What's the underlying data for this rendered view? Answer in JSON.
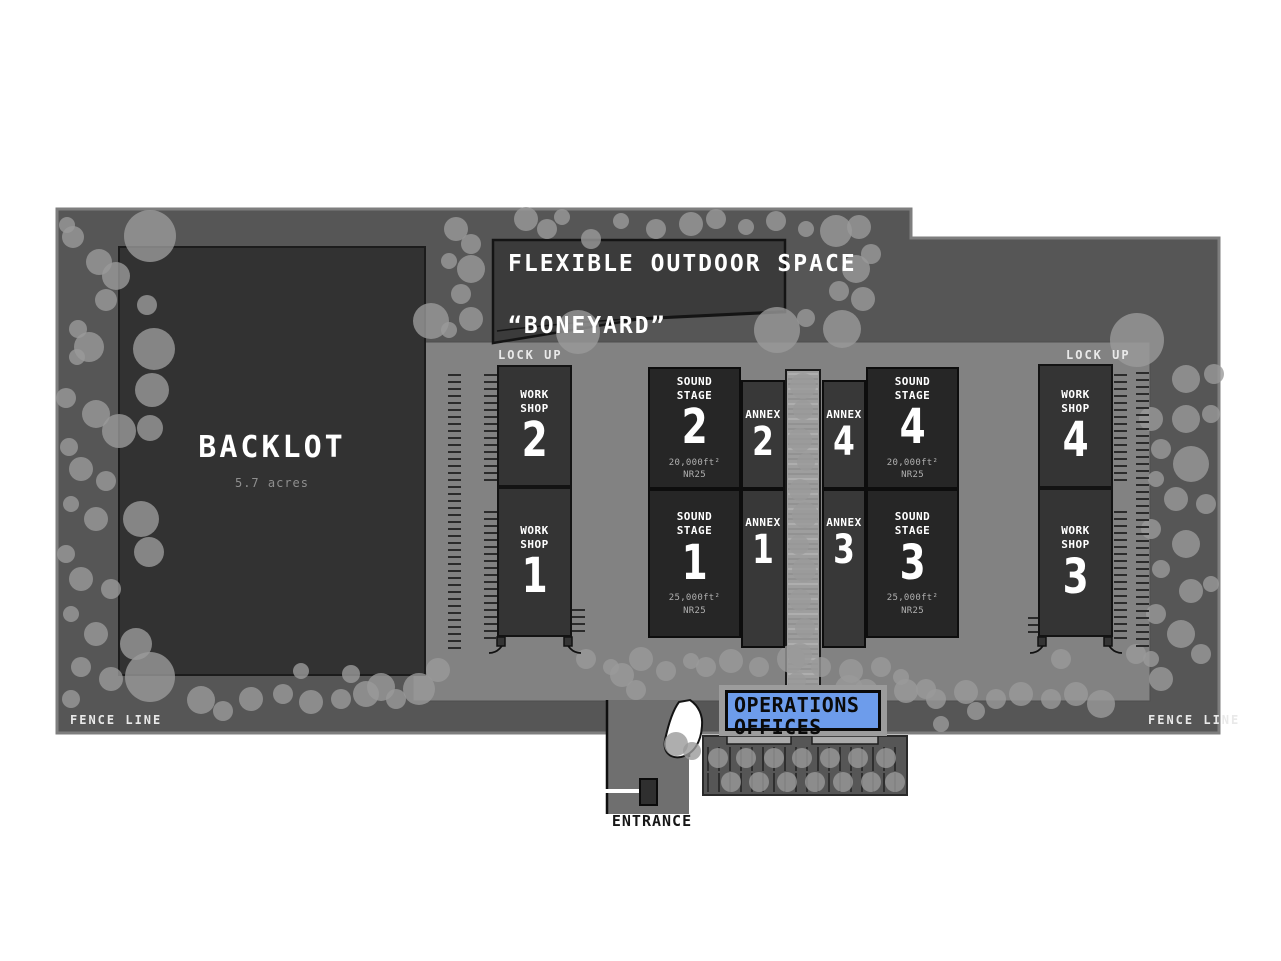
{
  "map": {
    "colors": {
      "band": "#565656",
      "band_border": "#7e7e7e",
      "lot": "#828282",
      "corridor": "#9e9e9e",
      "backlot": "#323232",
      "boneyard": "#3b3b3b",
      "stage": "#262626",
      "workshop": "#343434",
      "annex": "#383838",
      "tree": "#9a9a9a",
      "operations_blue": "#6d9ceb",
      "booth": "#2f2f2f",
      "parking_line": "#2f2f2f",
      "white_road": "#ffffff"
    },
    "labels": {
      "lockup_left": "LOCK UP",
      "lockup_right": "LOCK UP",
      "fence_left": "FENCE LINE",
      "fence_right": "FENCE LINE",
      "entrance": "ENTRANCE"
    },
    "backlot": {
      "name": "BACKLOT",
      "sub": "5.7 acres"
    },
    "boneyard": {
      "line1": "FLEXIBLE OUTDOOR SPACE",
      "line2": "“BONEYARD”"
    },
    "operations": {
      "line1": "OPERATIONS",
      "line2": "OFFICES"
    },
    "buildings": {
      "workshop2": {
        "l1": "WORK",
        "l2": "SHOP",
        "num": "2"
      },
      "workshop1": {
        "l1": "WORK",
        "l2": "SHOP",
        "num": "1"
      },
      "workshop4": {
        "l1": "WORK",
        "l2": "SHOP",
        "num": "4"
      },
      "workshop3": {
        "l1": "WORK",
        "l2": "SHOP",
        "num": "3"
      },
      "stage2": {
        "l1": "SOUND",
        "l2": "STAGE",
        "num": "2",
        "area": "20,000ft²",
        "nr": "NR25"
      },
      "stage1": {
        "l1": "SOUND",
        "l2": "STAGE",
        "num": "1",
        "area": "25,000ft²",
        "nr": "NR25"
      },
      "stage4": {
        "l1": "SOUND",
        "l2": "STAGE",
        "num": "4",
        "area": "20,000ft²",
        "nr": "NR25"
      },
      "stage3": {
        "l1": "SOUND",
        "l2": "STAGE",
        "num": "3",
        "area": "25,000ft²",
        "nr": "NR25"
      },
      "annex2": {
        "l1": "ANNEX",
        "num": "2"
      },
      "annex1": {
        "l1": "ANNEX",
        "num": "1"
      },
      "annex4": {
        "l1": "ANNEX",
        "num": "4"
      },
      "annex3": {
        "l1": "ANNEX",
        "num": "3"
      }
    },
    "trees": [
      [
        150,
        236,
        26
      ],
      [
        99,
        262,
        13
      ],
      [
        73,
        237,
        11
      ],
      [
        67,
        225,
        8
      ],
      [
        116,
        276,
        14
      ],
      [
        106,
        300,
        11
      ],
      [
        147,
        305,
        10
      ],
      [
        78,
        329,
        9
      ],
      [
        89,
        347,
        15
      ],
      [
        154,
        349,
        21
      ],
      [
        152,
        390,
        17
      ],
      [
        77,
        357,
        8
      ],
      [
        66,
        398,
        10
      ],
      [
        96,
        414,
        14
      ],
      [
        119,
        431,
        17
      ],
      [
        150,
        428,
        13
      ],
      [
        69,
        447,
        9
      ],
      [
        81,
        469,
        12
      ],
      [
        106,
        481,
        10
      ],
      [
        71,
        504,
        8
      ],
      [
        96,
        519,
        12
      ],
      [
        141,
        519,
        18
      ],
      [
        149,
        552,
        15
      ],
      [
        66,
        554,
        9
      ],
      [
        81,
        579,
        12
      ],
      [
        111,
        589,
        10
      ],
      [
        71,
        614,
        8
      ],
      [
        96,
        634,
        12
      ],
      [
        136,
        644,
        16
      ],
      [
        150,
        677,
        25
      ],
      [
        111,
        679,
        12
      ],
      [
        81,
        667,
        10
      ],
      [
        71,
        699,
        9
      ],
      [
        201,
        700,
        14
      ],
      [
        223,
        711,
        10
      ],
      [
        251,
        699,
        12
      ],
      [
        283,
        694,
        10
      ],
      [
        311,
        702,
        12
      ],
      [
        341,
        699,
        10
      ],
      [
        366,
        694,
        13
      ],
      [
        396,
        699,
        10
      ],
      [
        301,
        671,
        8
      ],
      [
        351,
        674,
        9
      ],
      [
        381,
        687,
        14
      ],
      [
        419,
        689,
        16
      ],
      [
        438,
        670,
        12
      ],
      [
        456,
        229,
        12
      ],
      [
        471,
        244,
        10
      ],
      [
        449,
        261,
        8
      ],
      [
        471,
        269,
        14
      ],
      [
        461,
        294,
        10
      ],
      [
        471,
        319,
        12
      ],
      [
        449,
        330,
        8
      ],
      [
        526,
        219,
        12
      ],
      [
        547,
        229,
        10
      ],
      [
        562,
        217,
        8
      ],
      [
        591,
        239,
        10
      ],
      [
        621,
        221,
        8
      ],
      [
        656,
        229,
        10
      ],
      [
        691,
        224,
        12
      ],
      [
        716,
        219,
        10
      ],
      [
        746,
        227,
        8
      ],
      [
        776,
        221,
        10
      ],
      [
        806,
        229,
        8
      ],
      [
        836,
        231,
        16
      ],
      [
        859,
        227,
        12
      ],
      [
        871,
        254,
        10
      ],
      [
        856,
        269,
        14
      ],
      [
        839,
        291,
        10
      ],
      [
        863,
        299,
        12
      ],
      [
        842,
        329,
        19
      ],
      [
        578,
        332,
        22
      ],
      [
        431,
        321,
        18
      ],
      [
        777,
        330,
        23
      ],
      [
        806,
        318,
        9
      ],
      [
        1137,
        340,
        27
      ],
      [
        1186,
        379,
        14
      ],
      [
        1214,
        374,
        10
      ],
      [
        1151,
        419,
        12
      ],
      [
        1186,
        419,
        14
      ],
      [
        1211,
        414,
        9
      ],
      [
        1161,
        449,
        10
      ],
      [
        1191,
        464,
        18
      ],
      [
        1156,
        479,
        8
      ],
      [
        1176,
        499,
        12
      ],
      [
        1206,
        504,
        10
      ],
      [
        1151,
        529,
        10
      ],
      [
        1186,
        544,
        14
      ],
      [
        1161,
        569,
        9
      ],
      [
        1191,
        591,
        12
      ],
      [
        1211,
        584,
        8
      ],
      [
        1156,
        614,
        10
      ],
      [
        1181,
        634,
        14
      ],
      [
        1201,
        654,
        10
      ],
      [
        1151,
        659,
        8
      ],
      [
        1136,
        654,
        10
      ],
      [
        1161,
        679,
        12
      ],
      [
        849,
        689,
        14
      ],
      [
        876,
        699,
        10
      ],
      [
        906,
        691,
        12
      ],
      [
        936,
        699,
        10
      ],
      [
        966,
        692,
        12
      ],
      [
        996,
        699,
        10
      ],
      [
        1021,
        694,
        12
      ],
      [
        1051,
        699,
        10
      ],
      [
        1076,
        694,
        12
      ],
      [
        1101,
        704,
        14
      ],
      [
        941,
        724,
        8
      ],
      [
        976,
        711,
        9
      ],
      [
        1061,
        659,
        10
      ],
      [
        586,
        659,
        10
      ],
      [
        611,
        667,
        8
      ],
      [
        622,
        675,
        12
      ],
      [
        641,
        659,
        12
      ],
      [
        666,
        671,
        10
      ],
      [
        691,
        661,
        8
      ],
      [
        636,
        690,
        10
      ],
      [
        706,
        667,
        10
      ],
      [
        731,
        661,
        12
      ],
      [
        759,
        667,
        10
      ],
      [
        791,
        659,
        14
      ],
      [
        821,
        667,
        10
      ],
      [
        851,
        671,
        12
      ],
      [
        881,
        667,
        10
      ],
      [
        901,
        677,
        8
      ],
      [
        866,
        691,
        12
      ],
      [
        926,
        689,
        10
      ],
      [
        803,
        386,
        13
      ],
      [
        803,
        410,
        10
      ],
      [
        800,
        440,
        12
      ],
      [
        806,
        462,
        9
      ],
      [
        800,
        490,
        11
      ],
      [
        805,
        515,
        13
      ],
      [
        799,
        545,
        10
      ],
      [
        804,
        570,
        12
      ],
      [
        800,
        600,
        11
      ],
      [
        805,
        628,
        10
      ],
      [
        800,
        655,
        12
      ],
      [
        797,
        681,
        9
      ]
    ],
    "parking_trees": [
      [
        718,
        758,
        10
      ],
      [
        746,
        758,
        10
      ],
      [
        774,
        758,
        10
      ],
      [
        802,
        758,
        10
      ],
      [
        830,
        758,
        10
      ],
      [
        858,
        758,
        10
      ],
      [
        886,
        758,
        10
      ],
      [
        731,
        782,
        10
      ],
      [
        759,
        782,
        10
      ],
      [
        787,
        782,
        10
      ],
      [
        815,
        782,
        10
      ],
      [
        843,
        782,
        10
      ],
      [
        871,
        782,
        10
      ],
      [
        895,
        782,
        10
      ],
      [
        676,
        744,
        12
      ],
      [
        692,
        751,
        9
      ]
    ],
    "fences": [
      {
        "x": 448,
        "y1": 375,
        "y2": 648
      },
      {
        "x": 484,
        "y1": 375,
        "y2": 485
      },
      {
        "x": 484,
        "y1": 512,
        "y2": 640
      },
      {
        "x": 572,
        "y1": 610,
        "y2": 634
      },
      {
        "x": 1114,
        "y1": 375,
        "y2": 485
      },
      {
        "x": 1114,
        "y1": 512,
        "y2": 640
      },
      {
        "x": 1136,
        "y1": 373,
        "y2": 650
      },
      {
        "x": 1028,
        "y1": 618,
        "y2": 636
      }
    ],
    "parking": {
      "x1": 708,
      "x2": 902,
      "step": 11,
      "row1": [
        747,
        771
      ],
      "row2": [
        773,
        792
      ]
    },
    "corridor_hatch": {
      "x1": 788,
      "x2": 818,
      "y1": 374,
      "y2": 694,
      "step": 5
    }
  }
}
